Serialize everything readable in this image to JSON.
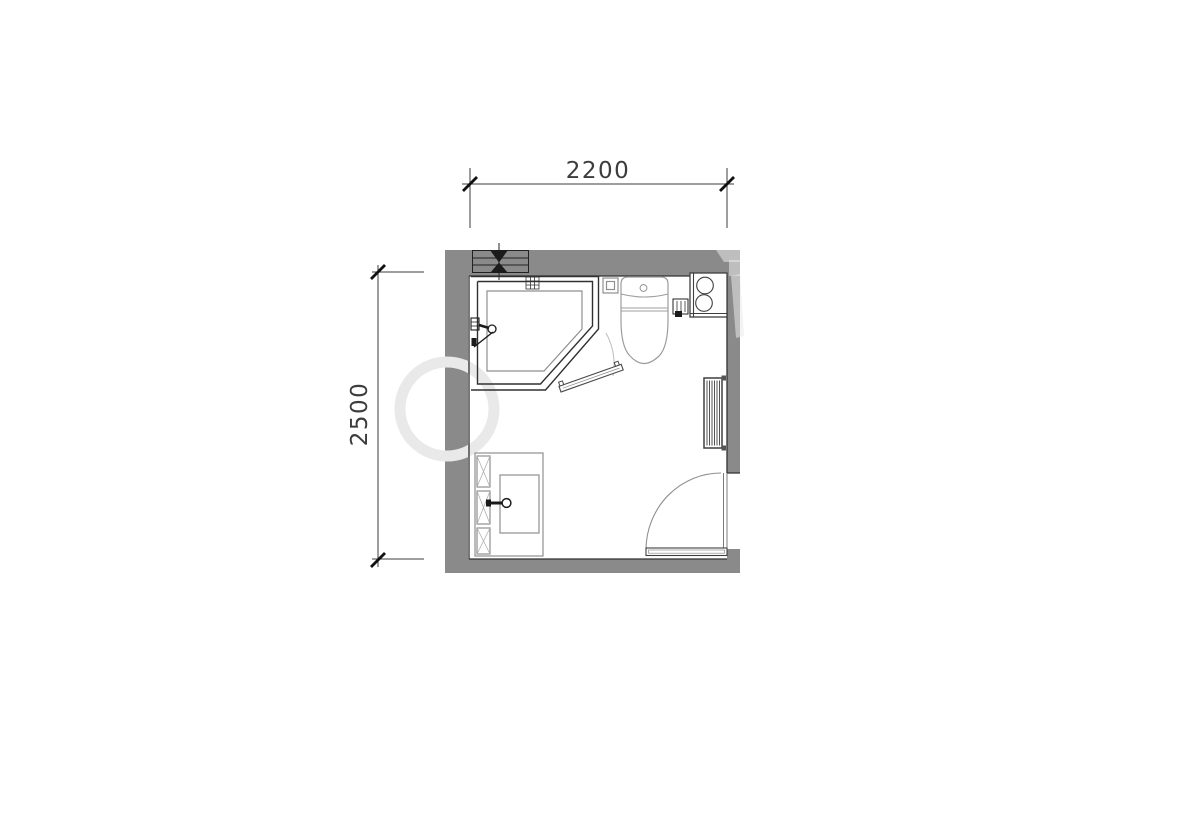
{
  "dimensions": {
    "width": "2200",
    "height": "2500"
  },
  "colors": {
    "bg": "#ffffff",
    "wall": "#8a8a8a",
    "line": "#303030",
    "fixture": "#8f8f8f",
    "toilet": "#9c9c9c",
    "dark": "#1b1b1b",
    "swing": "#8f8f8f",
    "faint": "#bdbdbd",
    "watermark": "#e9e9e9",
    "dim": "#3c3c3c"
  },
  "plan": {
    "fixtures": [
      "pipe-shaft-valve",
      "shower-enclosure",
      "shower-tray",
      "shower-mixer",
      "shower-door-panel",
      "wall-drain",
      "toilet",
      "water-inlet",
      "washing-machine",
      "tap-valve-box",
      "towel-radiator",
      "entry-door",
      "vanity-counter",
      "side-cabinet",
      "wash-basin",
      "basin-faucet"
    ]
  }
}
